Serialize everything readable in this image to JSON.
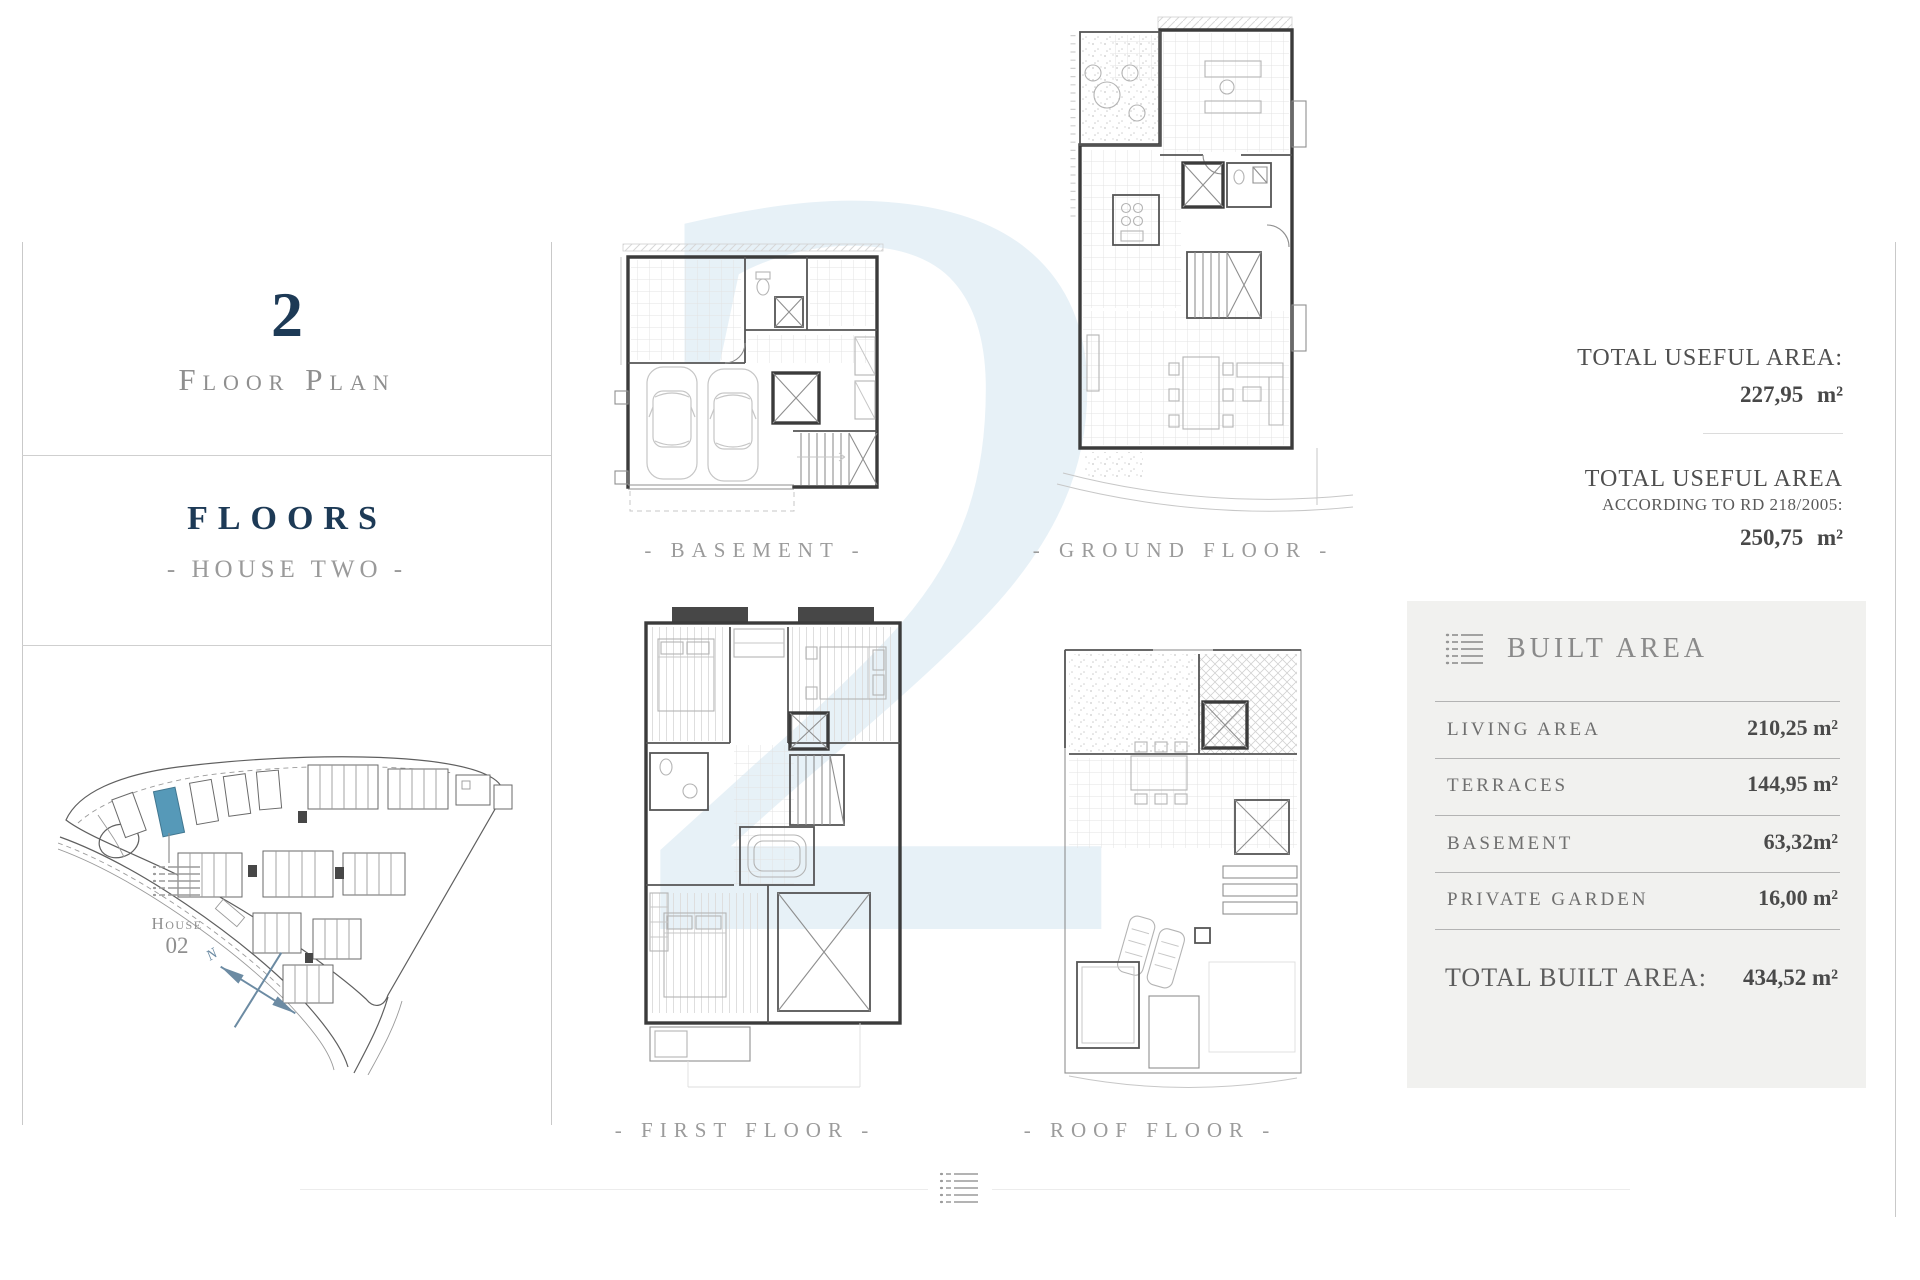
{
  "watermark": "2",
  "sidebar": {
    "plan_number": "2",
    "plan_label": "Floor Plan",
    "floors_title": "FLOORS",
    "floors_subtitle": "- HOUSE TWO -",
    "site_plan": {
      "house_word": "House",
      "house_number": "02",
      "compass_letter": "N",
      "highlight_color": "#5699b8"
    }
  },
  "floor_labels": {
    "basement": "- BASEMENT -",
    "ground": "- GROUND FLOOR -",
    "first": "- FIRST FLOOR -",
    "roof": "- ROOF FLOOR -"
  },
  "useful_area": {
    "block1_title": "TOTAL USEFUL AREA:",
    "block1_value": "227,95 m²",
    "block2_title": "TOTAL USEFUL AREA",
    "block2_subtitle": "ACCORDING TO RD 218/2005:",
    "block2_value": "250,75 m²"
  },
  "built_area": {
    "title": "BUILT AREA",
    "rows": [
      {
        "label": "LIVING AREA",
        "value": "210,25 m²"
      },
      {
        "label": "TERRACES",
        "value": "144,95 m²"
      },
      {
        "label": "BASEMENT",
        "value": "63,32m²"
      },
      {
        "label": "PRIVATE GARDEN",
        "value": "16,00 m²"
      }
    ],
    "total_label": "TOTAL BUILT AREA:",
    "total_value": "434,52 m²"
  },
  "colors": {
    "navy": "#1d3a56",
    "gray_text": "#8f8f8f",
    "value_text": "#4a4a4a",
    "panel_bg": "#f1f1ef",
    "highlight_blue": "#5699b8",
    "watermark_blue": "#e7f1f7",
    "compass_blue": "#6c8ba3"
  }
}
